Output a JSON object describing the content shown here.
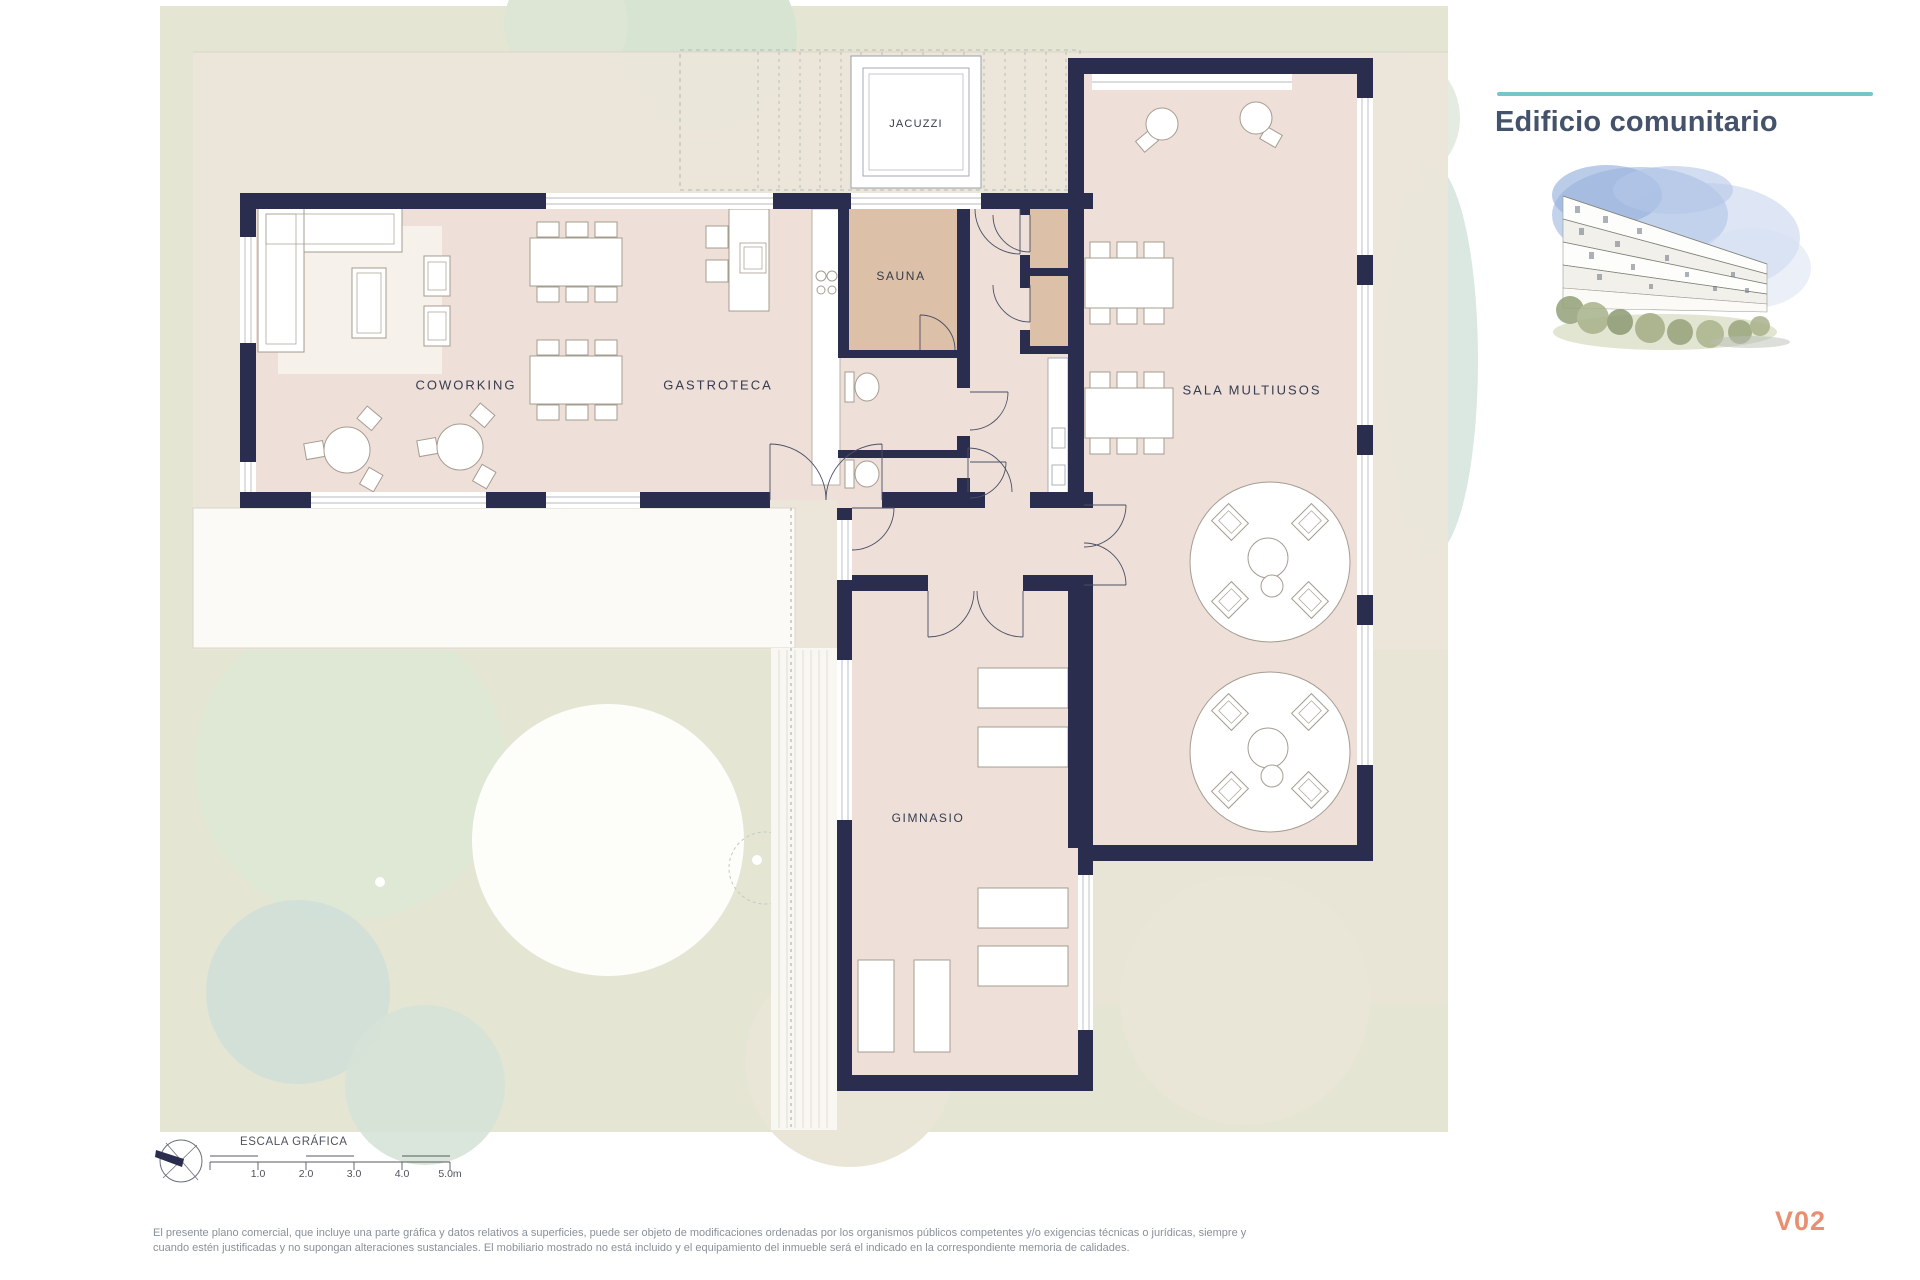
{
  "header": {
    "title": "Edificio comunitario",
    "accent_color": "#74c6cb",
    "title_color": "#44536b"
  },
  "plan": {
    "rooms": [
      {
        "id": "jacuzzi",
        "label": "JACUZZI"
      },
      {
        "id": "sauna",
        "label": "SAUNA"
      },
      {
        "id": "coworking",
        "label": "COWORKING"
      },
      {
        "id": "gastroteca",
        "label": "GASTROTECA"
      },
      {
        "id": "sala-multiusos",
        "label": "SALA MULTIUSOS"
      },
      {
        "id": "gimnasio",
        "label": "GIMNASIO"
      }
    ],
    "colors": {
      "wall": "#2a2d4d",
      "floor": "#eee0d9",
      "sauna_floor": "#dcc0a7",
      "landscape_green": "#e4e5d3",
      "terrace_beige": "#ebe6d9"
    }
  },
  "icons": {
    "compass": "compass-rose",
    "illustration": "building-watercolor"
  },
  "footer": {
    "scale_title": "ESCALA GRÁFICA",
    "scale_ticks": [
      "1.0",
      "2.0",
      "3.0",
      "4.0",
      "5.0m"
    ],
    "disclaimer_line1": "El presente plano comercial, que incluye una parte gráfica y datos relativos a superficies, puede ser objeto de modificaciones ordenadas por los organismos públicos competentes y/o exigencias técnicas o jurídicas, siempre y",
    "disclaimer_line2": "cuando estén justificadas y no supongan alteraciones sustanciales. El mobiliario mostrado no está incluido y el equipamiento del inmueble será el indicado en la correspondiente memoria de calidades.",
    "version": "V02",
    "version_color": "#e78f70"
  }
}
